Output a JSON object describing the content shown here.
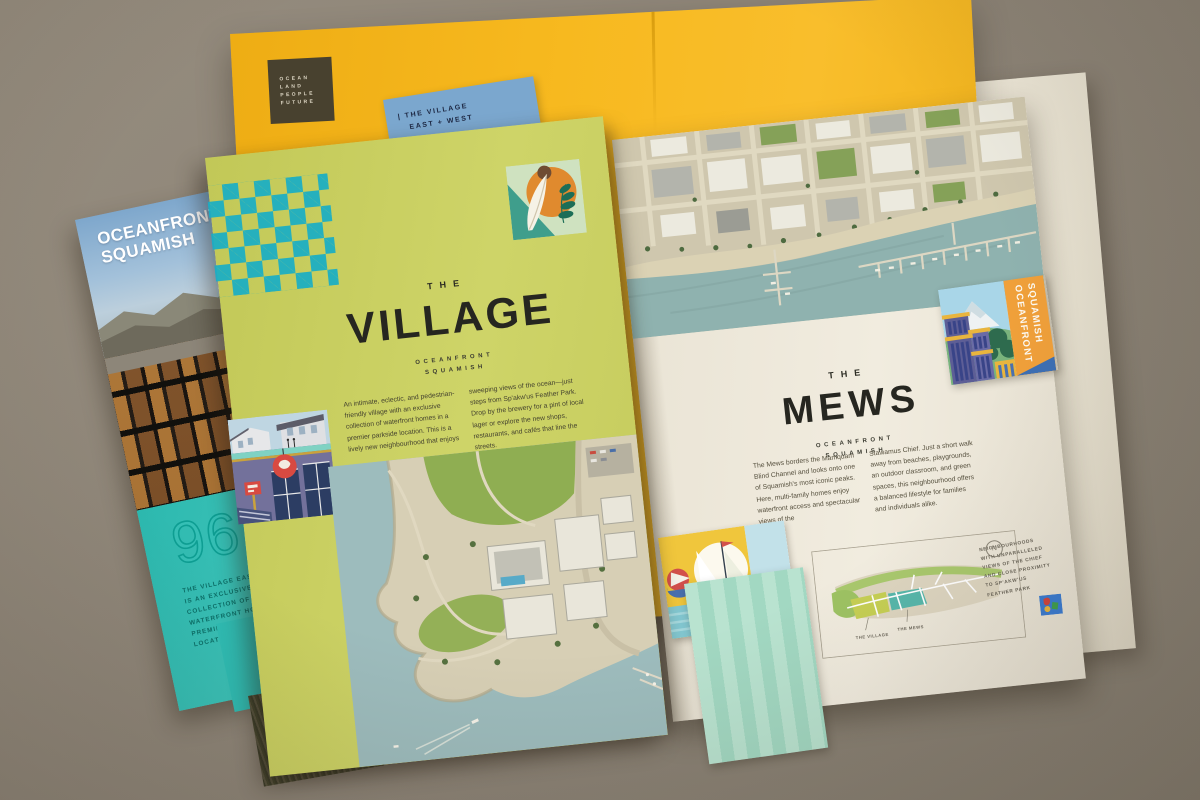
{
  "scene": {
    "background_color": "#8d8477",
    "description": "photograph of printed brochures on gray desk"
  },
  "folder": {
    "color": "#f7b91f",
    "logo_lines": [
      "OCEAN",
      "LAND",
      "PEOPLE",
      "FUTURE"
    ]
  },
  "cream_folder": {
    "color": "#ece6d6"
  },
  "blue_insert": {
    "color": "#7ba7ce",
    "line1": "| THE VILLAGE",
    "line2": "EAST + WEST"
  },
  "left_brochure": {
    "title_line1": "OCEANFRONT",
    "title_line2": "SQUAMISH",
    "stat": "96",
    "caption": "The Village East + West is an exclusive collection of 96 waterfront homes in a premier parkside location",
    "panel_color": "#2fbcb3"
  },
  "village_page": {
    "page_color": "#c9ce63",
    "checker_color": "#19aec6",
    "kicker": "THE",
    "title": "VILLAGE",
    "subtitle_line1": "OCEANFRONT",
    "subtitle_line2": "SQUAMISH",
    "copy_col1": "An intimate, eclectic, and pedestrian-friendly village with an exclusive collection of waterfront homes in a premier parkside location. This is a lively new neighbourhood that enjoys",
    "copy_col2": "sweeping views of the ocean—just steps from Sp'akw'us Feather Park. Drop by the brewery for a pint of local lager or explore the new shops, restaurants, and cafés that line the streets."
  },
  "mews_page": {
    "page_color": "#ece7da",
    "kicker": "THE",
    "title": "MEWS",
    "subtitle_line1": "OCEANFRONT",
    "subtitle_line2": "SQUAMISH",
    "copy_col1": "The Mews borders the Mamquam Blind Channel and looks onto one of Squamish's most iconic peaks. Here, multi-family homes enjoy waterfront access and spectacular views of the",
    "copy_col2": "Stawamus Chief. Just a short walk away from beaches, playgrounds, an outdoor classroom, and green spaces, this neighbourhood offers a balanced lifestyle for families and individuals alike.",
    "map": {
      "compass": "N",
      "label_village": "THE VILLAGE",
      "label_mews": "THE MEWS"
    },
    "caption": "Neighbourhoods with unparalleled views of the Chief and close proximity to Sp'akw'us Feather Park"
  },
  "side_tab": {
    "color": "#f0a03a",
    "line1": "OCEANFRONT",
    "line2": "SQUAMISH"
  }
}
